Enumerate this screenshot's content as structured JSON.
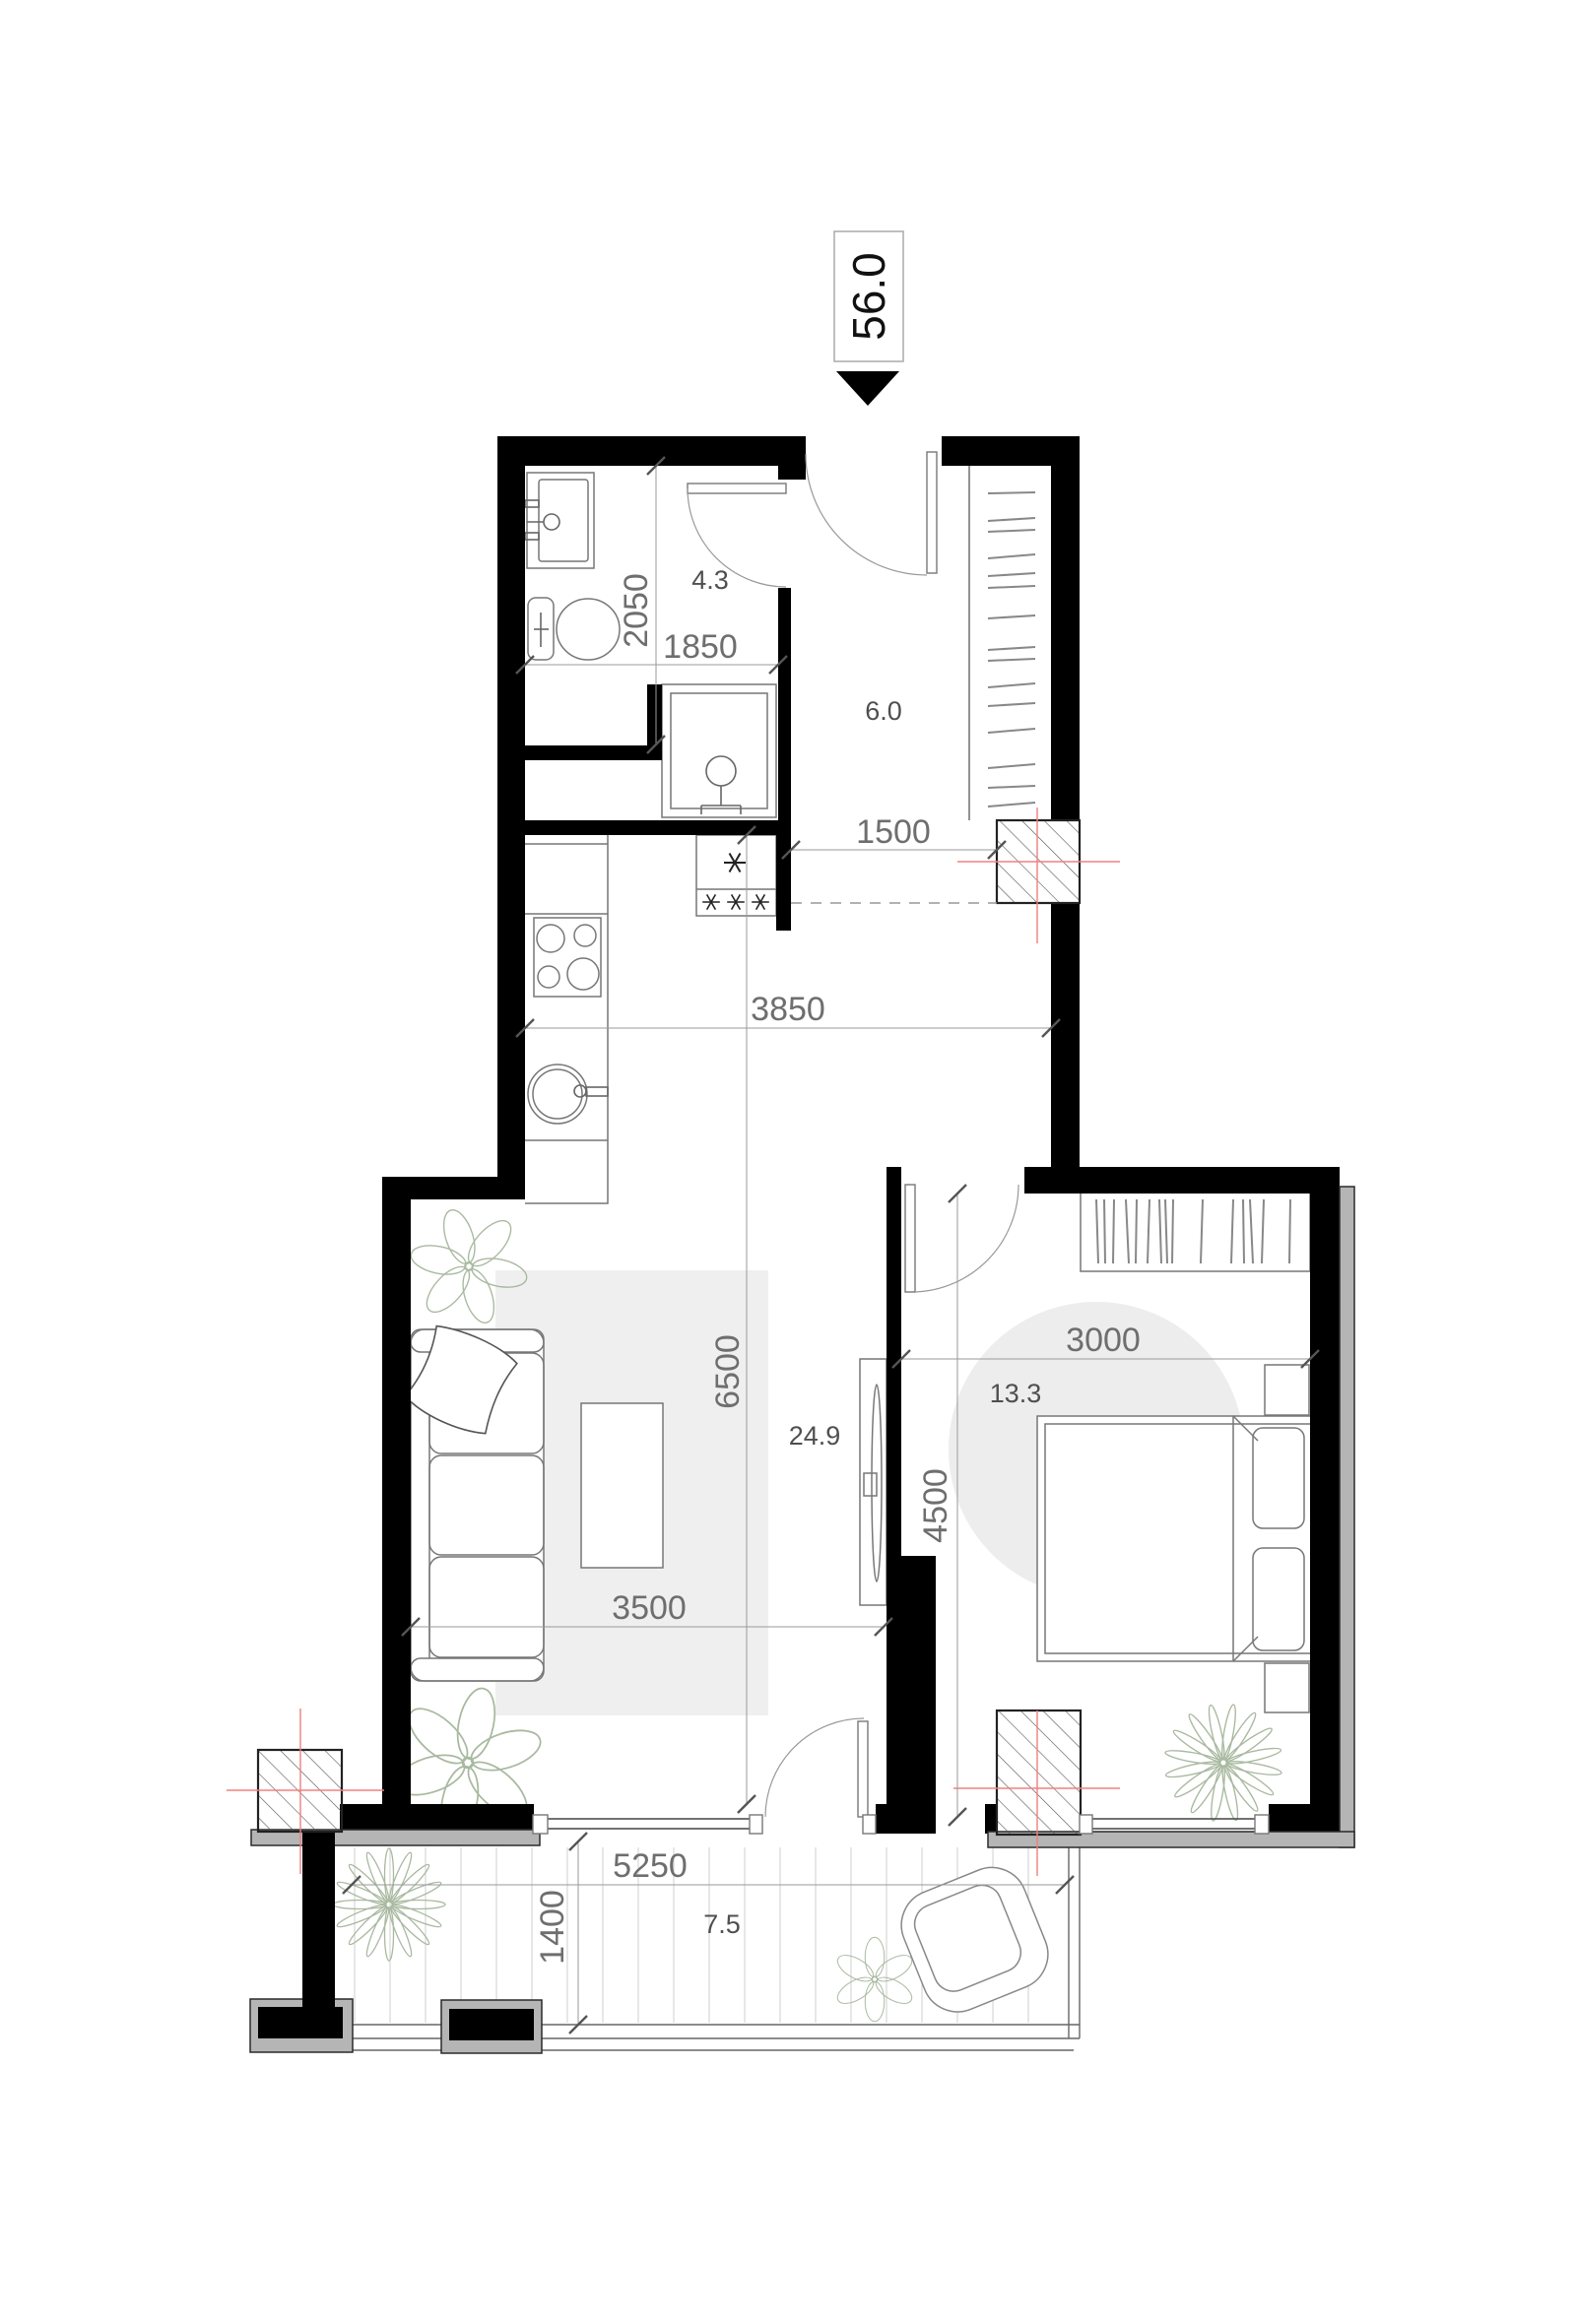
{
  "marker": {
    "value": "56.0"
  },
  "rooms": {
    "bathroom": "4.3",
    "hallway": "6.0",
    "living_kitchen": "24.9",
    "bedroom": "13.3",
    "balcony": "7.5"
  },
  "dims": {
    "bath_h": "2050",
    "bath_w": "1850",
    "opening": "1500",
    "kitchen_w": "3850",
    "living_h": "6500",
    "living_w": "3500",
    "bedroom_w": "3000",
    "bedroom_h": "4500",
    "balcony_w": "5250",
    "balcony_d": "1400"
  },
  "colors": {
    "wall": "#000000",
    "dim_text": "#6e6e6e",
    "room_text": "#4f4f4f",
    "red_axis": "#f08080",
    "rug": "#efefef",
    "plant": "#a9b9a0",
    "exterior_band": "#b5b5b5"
  },
  "icons": {
    "entry_marker": "down-triangle-icon"
  }
}
